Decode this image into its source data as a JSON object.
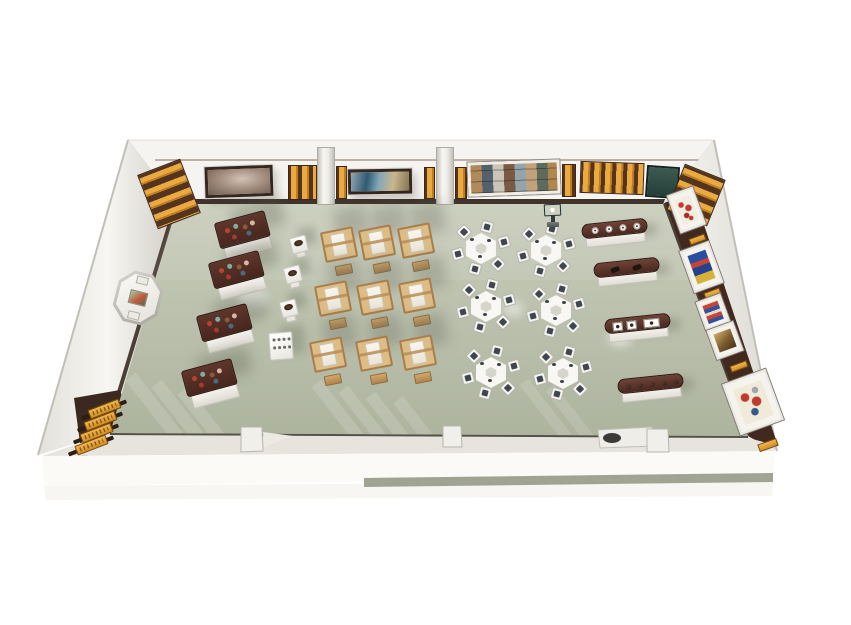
{
  "description": "Top-down 3D render of an exhibition and craft-workshop room with display cases, weaving looms, hexagonal activity tables, console vitrines, wall artworks and an info kiosk",
  "palette": {
    "background": "#ffffff",
    "floor": "#b9bfab",
    "floor_light": "#c9cdbb",
    "floor_dark": "#adb49e",
    "wall": "#f5f4f0",
    "wall_top_strip": "#dcd9d2",
    "trim_dark": "#3f332c",
    "wood_dark_top": "#4a2921",
    "wood_mid": "#6e4336",
    "base_white": "#f3f1eb",
    "gold": "#e9a93f",
    "gold_dark": "#b97a1e",
    "loom_wood": "#dcbd86",
    "fabric_white": "#f4f1e9",
    "seat_dark": "#40474f",
    "teal_panel": "#31514b",
    "screen_blue": "#2f9fd8",
    "art_band_brown": "#41291f",
    "artifact_colors": [
      "#b6452f",
      "#7fae9f",
      "#8a5a3b",
      "#d9b6a2",
      "#a03c2e",
      "#4a6b84"
    ]
  },
  "scene": {
    "furniture": {
      "display_cases": [
        {
          "x": 244,
          "y": 236,
          "rot": -15
        },
        {
          "x": 238,
          "y": 276,
          "rot": -15
        },
        {
          "x": 226,
          "y": 329,
          "rot": -15
        },
        {
          "x": 211,
          "y": 384,
          "rot": -15
        }
      ],
      "case_item_offsets": [
        [
          8,
          7
        ],
        [
          17,
          5
        ],
        [
          26,
          8
        ],
        [
          34,
          6
        ],
        [
          13,
          15
        ],
        [
          28,
          15
        ]
      ],
      "artifact_stands": [
        {
          "x": 299,
          "y": 247
        },
        {
          "x": 293,
          "y": 277
        },
        {
          "x": 289,
          "y": 311
        }
      ],
      "cube_pedestals": [
        {
          "x": 281,
          "y": 346
        }
      ],
      "looms": [
        {
          "x": 340,
          "y": 252
        },
        {
          "x": 378,
          "y": 250
        },
        {
          "x": 417,
          "y": 248
        },
        {
          "x": 334,
          "y": 306
        },
        {
          "x": 376,
          "y": 305
        },
        {
          "x": 418,
          "y": 303
        },
        {
          "x": 329,
          "y": 362
        },
        {
          "x": 375,
          "y": 361
        },
        {
          "x": 419,
          "y": 360
        }
      ],
      "hex_tables": [
        {
          "x": 481,
          "y": 249
        },
        {
          "x": 546,
          "y": 251
        },
        {
          "x": 486,
          "y": 307
        },
        {
          "x": 556,
          "y": 311
        },
        {
          "x": 491,
          "y": 373
        },
        {
          "x": 563,
          "y": 374
        }
      ],
      "hex_chairs_per_table": 6,
      "consoles": [
        {
          "x": 615,
          "y": 233,
          "rot": -6,
          "contents": "cups",
          "count": 4
        },
        {
          "x": 627,
          "y": 272,
          "rot": -6,
          "contents": "artifacts",
          "count": 2
        },
        {
          "x": 638,
          "y": 328,
          "rot": -6,
          "contents": "pictures",
          "count": 3
        },
        {
          "x": 651,
          "y": 388,
          "rot": -6,
          "contents": "knobs",
          "count": 5
        }
      ],
      "kiosk": {
        "x": 553,
        "y": 216
      }
    },
    "walls": {
      "top_items": [
        {
          "type": "slat",
          "name": "corner-slat-panel-left",
          "x": 146,
          "y": 165,
          "w": 46,
          "h": 58,
          "rot": -21,
          "bars": "h"
        },
        {
          "type": "picture",
          "name": "framed-photo-pottery",
          "variant": "pottery",
          "x": 205,
          "y": 166,
          "w": 68,
          "h": 31,
          "rot": -2
        },
        {
          "type": "slat",
          "name": "gold-slat-panel-a",
          "x": 288,
          "y": 165,
          "w": 29,
          "h": 35,
          "rot": 0,
          "bars": "v"
        },
        {
          "type": "pillar",
          "name": "wall-pillar-a",
          "x": 317,
          "y": 147,
          "w": 18,
          "h": 58
        },
        {
          "type": "slat",
          "name": "gold-slat-strip-a2",
          "x": 336,
          "y": 166,
          "w": 11,
          "h": 33,
          "rot": 0,
          "bars": "v"
        },
        {
          "type": "picture",
          "name": "framed-painting-landscape",
          "variant": "landscape",
          "x": 348,
          "y": 169,
          "w": 64,
          "h": 25,
          "rot": -1
        },
        {
          "type": "slat",
          "name": "gold-slat-strip-b1",
          "x": 424,
          "y": 167,
          "w": 11,
          "h": 32,
          "rot": 0,
          "bars": "v"
        },
        {
          "type": "pillar",
          "name": "wall-pillar-b",
          "x": 436,
          "y": 147,
          "w": 18,
          "h": 58
        },
        {
          "type": "slat",
          "name": "gold-slat-strip-b2",
          "x": 455,
          "y": 167,
          "w": 12,
          "h": 32,
          "rot": 0,
          "bars": "v"
        },
        {
          "type": "picture",
          "name": "framed-photo-collage",
          "variant": "collage",
          "x": 468,
          "y": 161,
          "w": 92,
          "h": 34,
          "rot": -2,
          "frame": "white"
        },
        {
          "type": "slat",
          "name": "gold-slat-strip-c1",
          "x": 562,
          "y": 164,
          "w": 14,
          "h": 33,
          "rot": 0,
          "bars": "v"
        },
        {
          "type": "slat",
          "name": "gold-slat-panel-c",
          "x": 580,
          "y": 162,
          "w": 64,
          "h": 32,
          "rot": 2,
          "bars": "v"
        },
        {
          "type": "teal",
          "name": "teal-wall-panel",
          "x": 646,
          "y": 166,
          "w": 33,
          "h": 32,
          "rot": 4
        },
        {
          "type": "slat",
          "name": "corner-slat-panel-right",
          "x": 674,
          "y": 170,
          "w": 44,
          "h": 50,
          "rot": 22,
          "bars": "h"
        }
      ],
      "left_octagon_frame": {
        "x": 138,
        "y": 298,
        "w": 46,
        "h": 52,
        "rot": 14
      },
      "left_plaques": [
        {
          "x": 104,
          "y": 409
        },
        {
          "x": 100,
          "y": 421
        },
        {
          "x": 96,
          "y": 433
        },
        {
          "x": 91,
          "y": 445
        }
      ],
      "right_rot": -20,
      "right_items": [
        {
          "type": "art",
          "name": "wall-art-red-pattern",
          "variant": "red",
          "x": 686,
          "y": 210,
          "w": 27,
          "h": 40
        },
        {
          "type": "label",
          "name": "art-label-1",
          "x": 697,
          "y": 239,
          "w": 17,
          "h": 7
        },
        {
          "type": "art",
          "name": "wall-art-blue-textile",
          "variant": "blue",
          "x": 701,
          "y": 267,
          "w": 31,
          "h": 44
        },
        {
          "type": "label",
          "name": "art-label-2",
          "x": 712,
          "y": 293,
          "w": 17,
          "h": 7
        },
        {
          "type": "art",
          "name": "wall-art-multi-textile",
          "variant": "multi",
          "x": 713,
          "y": 312,
          "w": 26,
          "h": 30
        },
        {
          "type": "art",
          "name": "wall-art-gold-print",
          "variant": "gold",
          "x": 725,
          "y": 340,
          "w": 28,
          "h": 31
        },
        {
          "type": "label",
          "name": "art-label-3",
          "x": 739,
          "y": 366,
          "w": 18,
          "h": 7
        },
        {
          "type": "art",
          "name": "wall-art-figure-painting",
          "variant": "figures",
          "x": 753,
          "y": 402,
          "w": 46,
          "h": 54
        },
        {
          "type": "label",
          "name": "art-label-4",
          "x": 768,
          "y": 445,
          "w": 20,
          "h": 8
        }
      ]
    }
  }
}
